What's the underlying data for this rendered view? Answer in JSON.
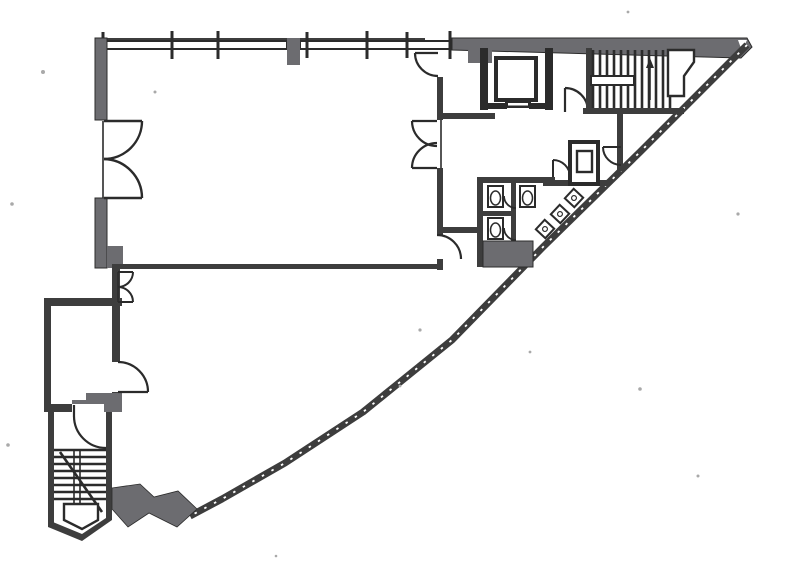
{
  "document": {
    "kind": "scanned-architectural-floor-plan",
    "visible_text": "",
    "orientation": "plan-view"
  },
  "palette": {
    "paper": "#ffffff",
    "ink": "#2b2b2b",
    "ink_soft": "#3d3d3d",
    "wall_gray": "#6c6c70",
    "shade_gray": "#7d7d80",
    "noise": "#a9a9a9"
  },
  "plan": {
    "rooms": [
      "large-office-room-northwest",
      "large-open-room-south",
      "annex-room-west",
      "elevator-lobby",
      "service-corridor",
      "toilet-block",
      "stairwell-northeast",
      "stairwell-southwest"
    ],
    "symbols": [
      "window-bay",
      "mullion-tick",
      "double-swing-door",
      "single-swing-door",
      "elevator-car",
      "stair-treads",
      "stair-landing",
      "wc-fixture",
      "wash-basin",
      "service-shaft",
      "curved-street-facade",
      "entrance-canopy"
    ],
    "counts": {
      "window_bays": 6,
      "mullion_ticks": 7,
      "double_swing_doors": 3,
      "single_swing_doors": 8,
      "elevators": 1,
      "staircases": 2,
      "wc_fixtures": 3,
      "wash_basins": 3
    }
  }
}
